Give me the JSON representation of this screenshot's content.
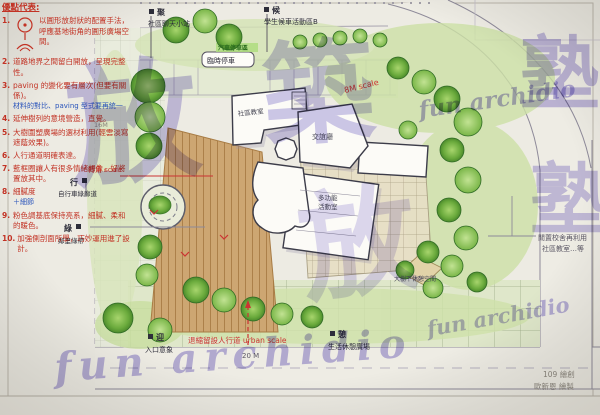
{
  "notes": {
    "title": "優點代表:",
    "items": [
      {
        "n": "1.",
        "t": "以圓形放射狀的配置手法，呼應基地街角的圓形廣場空間。"
      },
      {
        "n": "2.",
        "t": "道路地界之間留白開放，呈現完整性。"
      },
      {
        "n": "3.",
        "t": "paving 的變化要有層次(但要有關係)。",
        "sub": "材料的對比、paving 型式要再統一"
      },
      {
        "n": "4.",
        "t": "延伸樹列的意境營造，直覺。"
      },
      {
        "n": "5.",
        "t": "大樹圍塑廣場的選材利用(輕雲淡寫遮蔭效果)。"
      },
      {
        "n": "6.",
        "t": "人行通道明確表達。"
      },
      {
        "n": "7.",
        "t": "藍框圈讓人有很多情緒想像，好將置放其中。"
      },
      {
        "n": "8.",
        "t": "細膩度",
        "sub": "＋細節"
      },
      {
        "n": "9.",
        "t": "粉色調基底保持亮系，細膩、柔和的暖色。"
      },
      {
        "n": "10.",
        "t": "加強側剖面所學，巧妙運用進了設計。"
      }
    ]
  },
  "plan_labels": {
    "gather_key": "聚",
    "gather_text": "社區聊天小站",
    "wait_key": "候",
    "wait_text": "學生候車活動區B",
    "bike_key": "行",
    "bike_text": "自行車綠廊道",
    "green_key": "綠",
    "green_text": "鄰里綠帶",
    "entry_key": "迎",
    "entry_text": "入口意象",
    "rest_key": "憩",
    "rest_text": "生活休憩廣場",
    "parking_green": "汽車停車區",
    "parking_temp": "臨時停車",
    "corner_scale": "轉角 scale",
    "mid_scale": "8M scale",
    "urban_scale": "退縮留設人行道 urban scale",
    "urban_dim": "20 M",
    "dim_16m": "16M",
    "reuse_1": "閒置校舍再利用",
    "reuse_2": "社區教室…等",
    "bldg_classroom": "社區教室",
    "bldg_lounge": "交誼廳",
    "bldg_multi_1": "多功能",
    "bldg_multi_2": "活動室",
    "tree_rest": "大樹下休憩空間"
  },
  "credits": {
    "line1": "109 繪創",
    "line2": "歐新恩 繪製"
  },
  "watermarks": {
    "cn_a": "放",
    "cn_b": "築",
    "cn_c": "塾",
    "cn_d": "塾",
    "cn_e": "放",
    "script_a": "fun archidio",
    "script_b": "fun archidio",
    "script_c": "fun archidio"
  },
  "colors": {
    "watermark": "#7e6fd0",
    "red_ink": "#c23224",
    "lawn": "#cde1a6",
    "deck": "#cda672",
    "tree": "#6aaa3c"
  }
}
